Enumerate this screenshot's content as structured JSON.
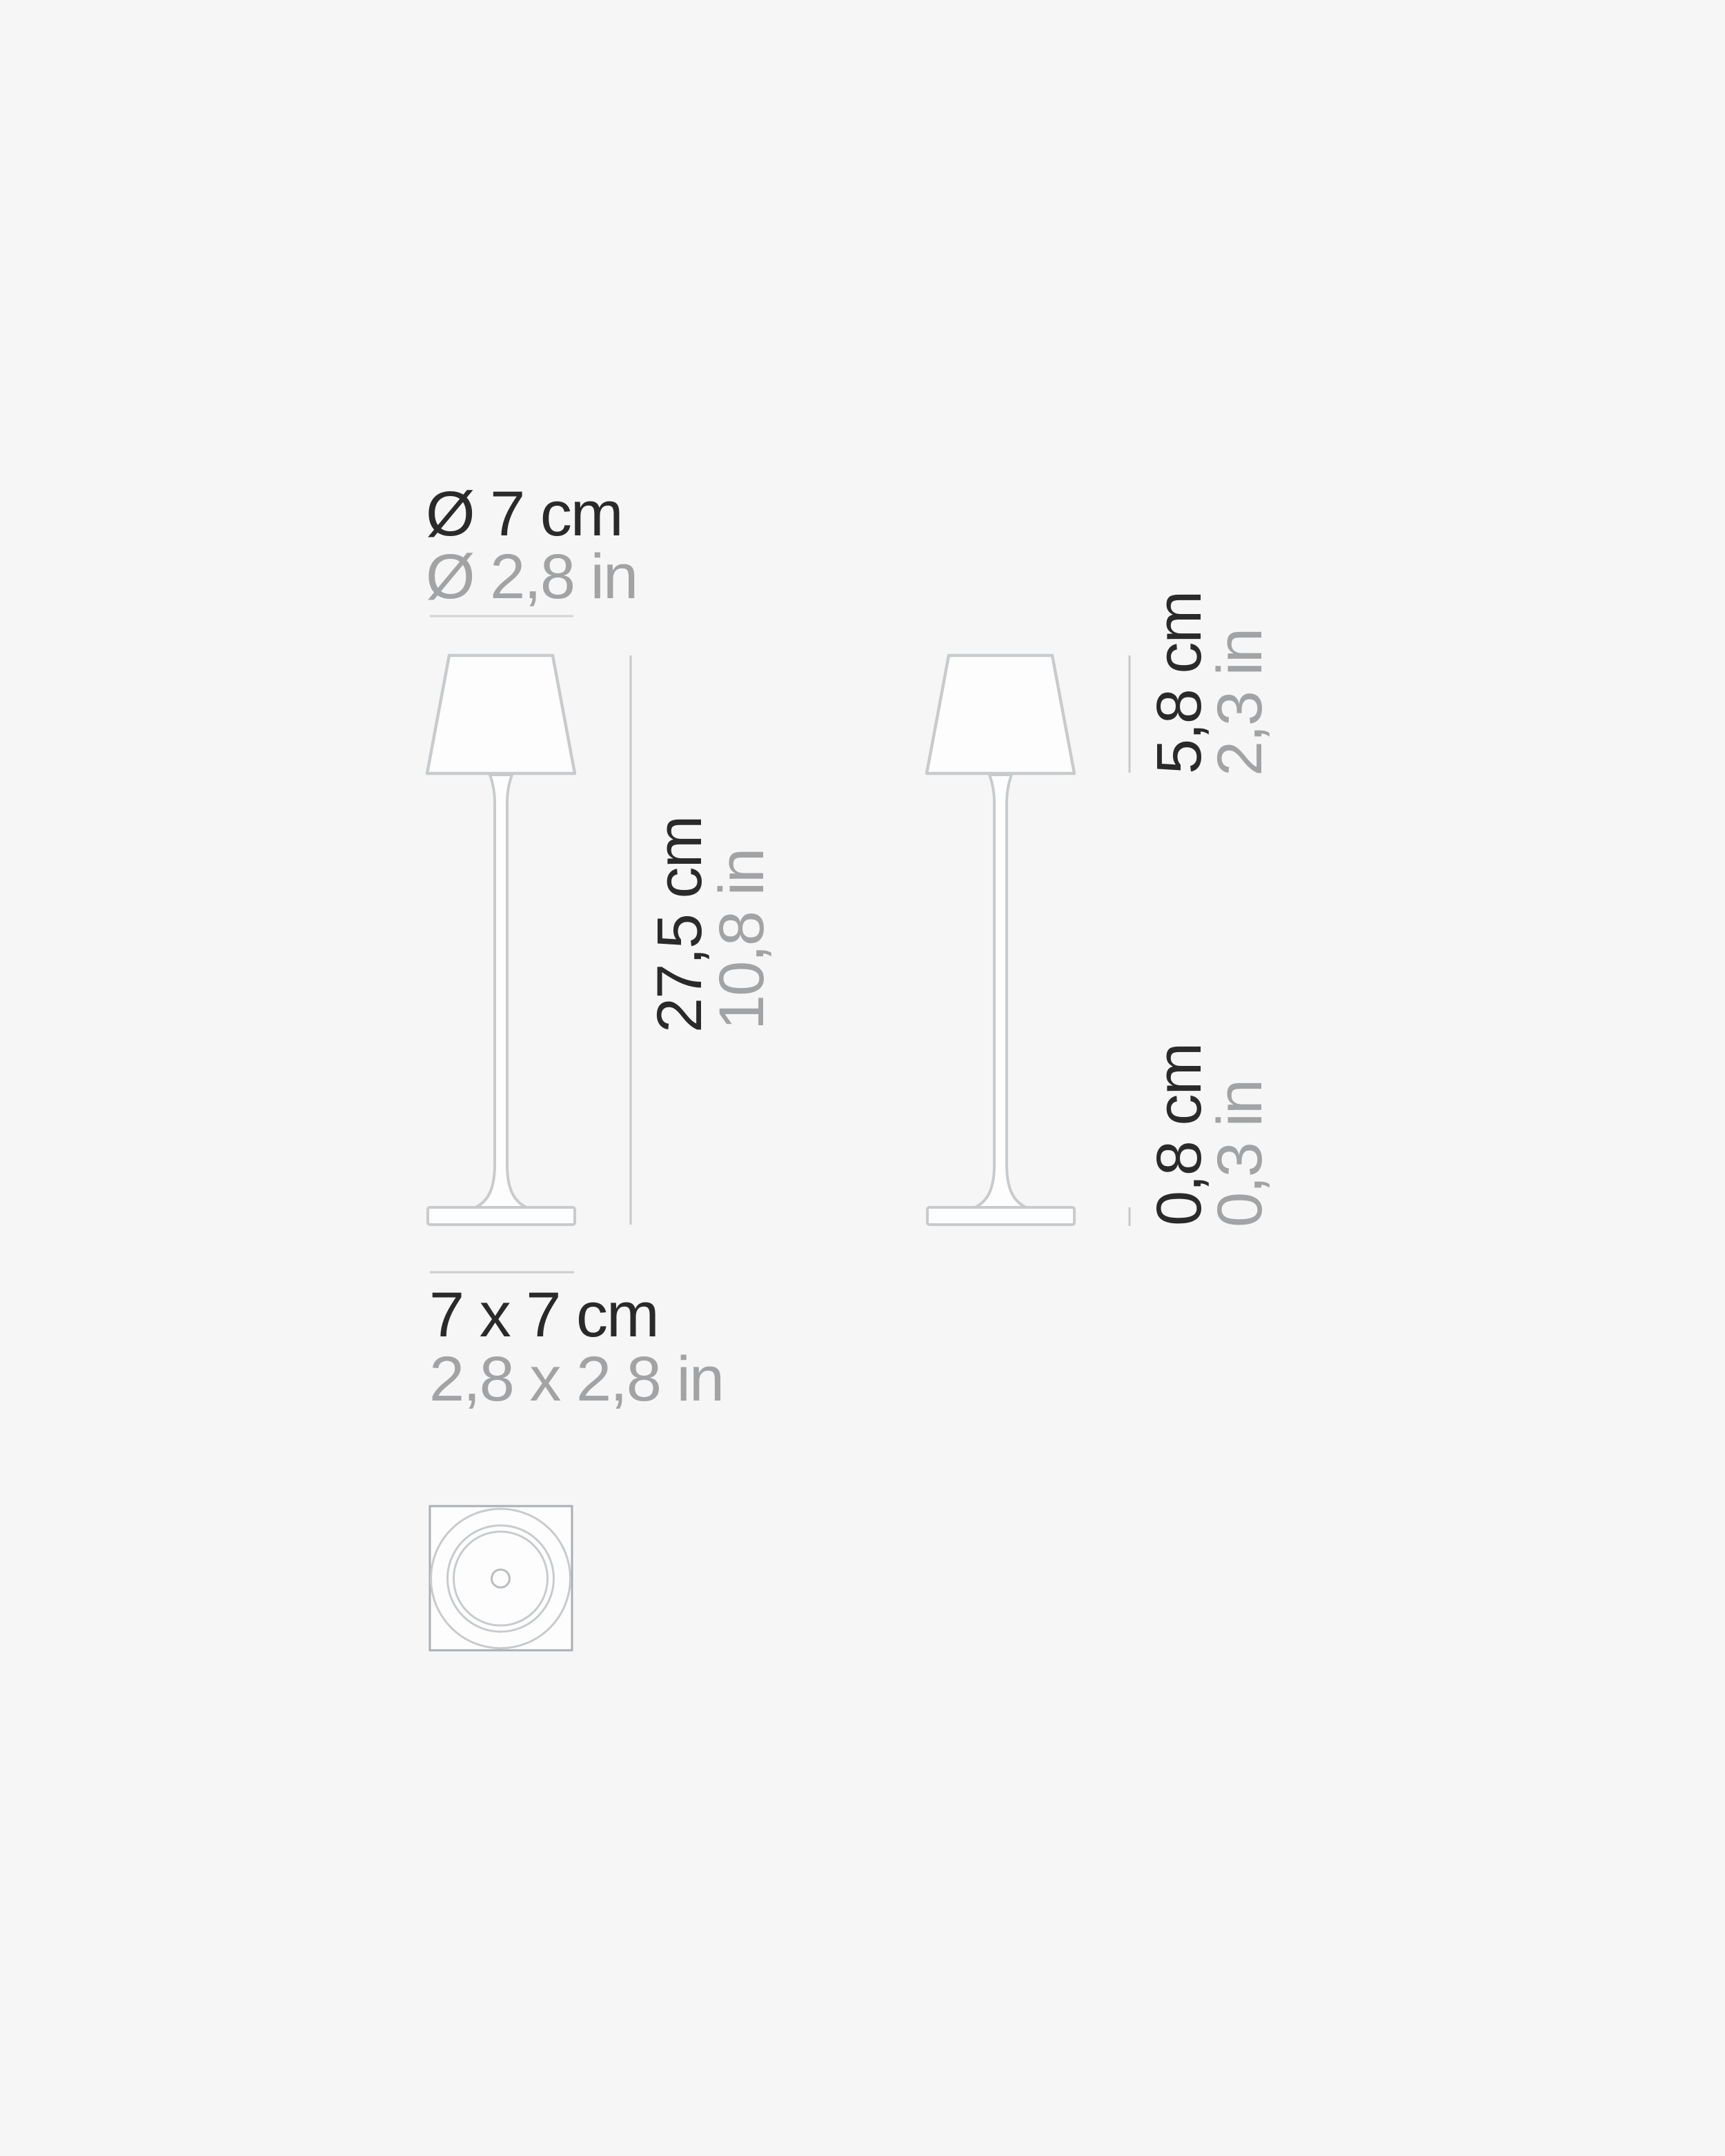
{
  "product_drawing": {
    "type": "table-lamp dimension diagram",
    "front": {
      "diameter": {
        "cm": "Ø 7 cm",
        "inch": "Ø 2,8 in"
      },
      "height": {
        "cm": "27,5 cm",
        "inch": "10,8 in"
      },
      "footprint": {
        "cm": "7 x 7 cm",
        "inch": "2,8 x 2,8 in"
      }
    },
    "side": {
      "shade_height": {
        "cm": "5,8 cm",
        "inch": "2,3 in"
      },
      "base_height": {
        "cm": "0,8 cm",
        "inch": "0,3 in"
      }
    },
    "colors": {
      "background": "#f6f6f7",
      "text_primary": "#2a2a2a",
      "text_secondary": "#a2a3a4",
      "dimension_line": "#c6c8c9",
      "outline": "#c8cbcd",
      "outline_square": "#aaafb1",
      "fill": "#fdfdfe"
    }
  }
}
